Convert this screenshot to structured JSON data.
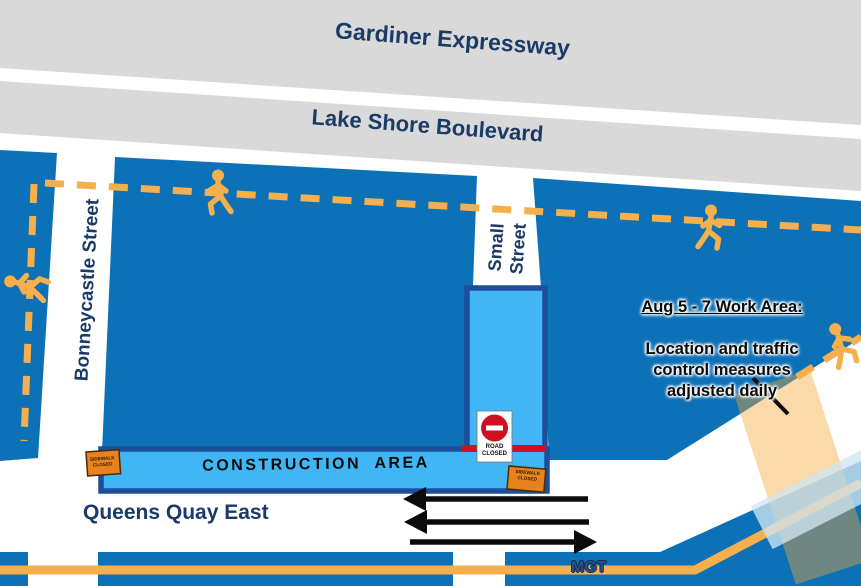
{
  "roads": {
    "gardiner_expressway": "Gardiner Expressway",
    "lake_shore_boulevard": "Lake Shore Boulevard",
    "bonneycastle_street": "Bonneycastle Street",
    "small_street": "Small\nStreet",
    "queens_quay_east": "Queens Quay East",
    "mgt_trail": "MGT"
  },
  "annotations": {
    "construction_area": "CONSTRUCTION  AREA",
    "work_area_heading": "Aug 5 - 7 Work Area:",
    "work_area_body": "Location and traffic\ncontrol measures\nadjusted daily"
  },
  "signs": {
    "road_closed": "ROAD\nCLOSED",
    "sidewalk_closed": "SIDEWALK\nCLOSED"
  },
  "icons": {
    "pedestrian": "walking-pedestrian",
    "no_entry": "no-entry-symbol"
  },
  "colors": {
    "road_blue": "#0d71b8",
    "closure_light_blue": "#41b6f5",
    "closure_border_navy": "#1d4e9e",
    "highway_gray": "#d9d9d9",
    "pedestrian_yellow": "#f5b04d",
    "sign_orange": "#e8821e",
    "alert_red": "#cf1020",
    "label_navy": "#1a3a67",
    "work_area_highlight": "rgba(245,166,53,0.42)"
  }
}
